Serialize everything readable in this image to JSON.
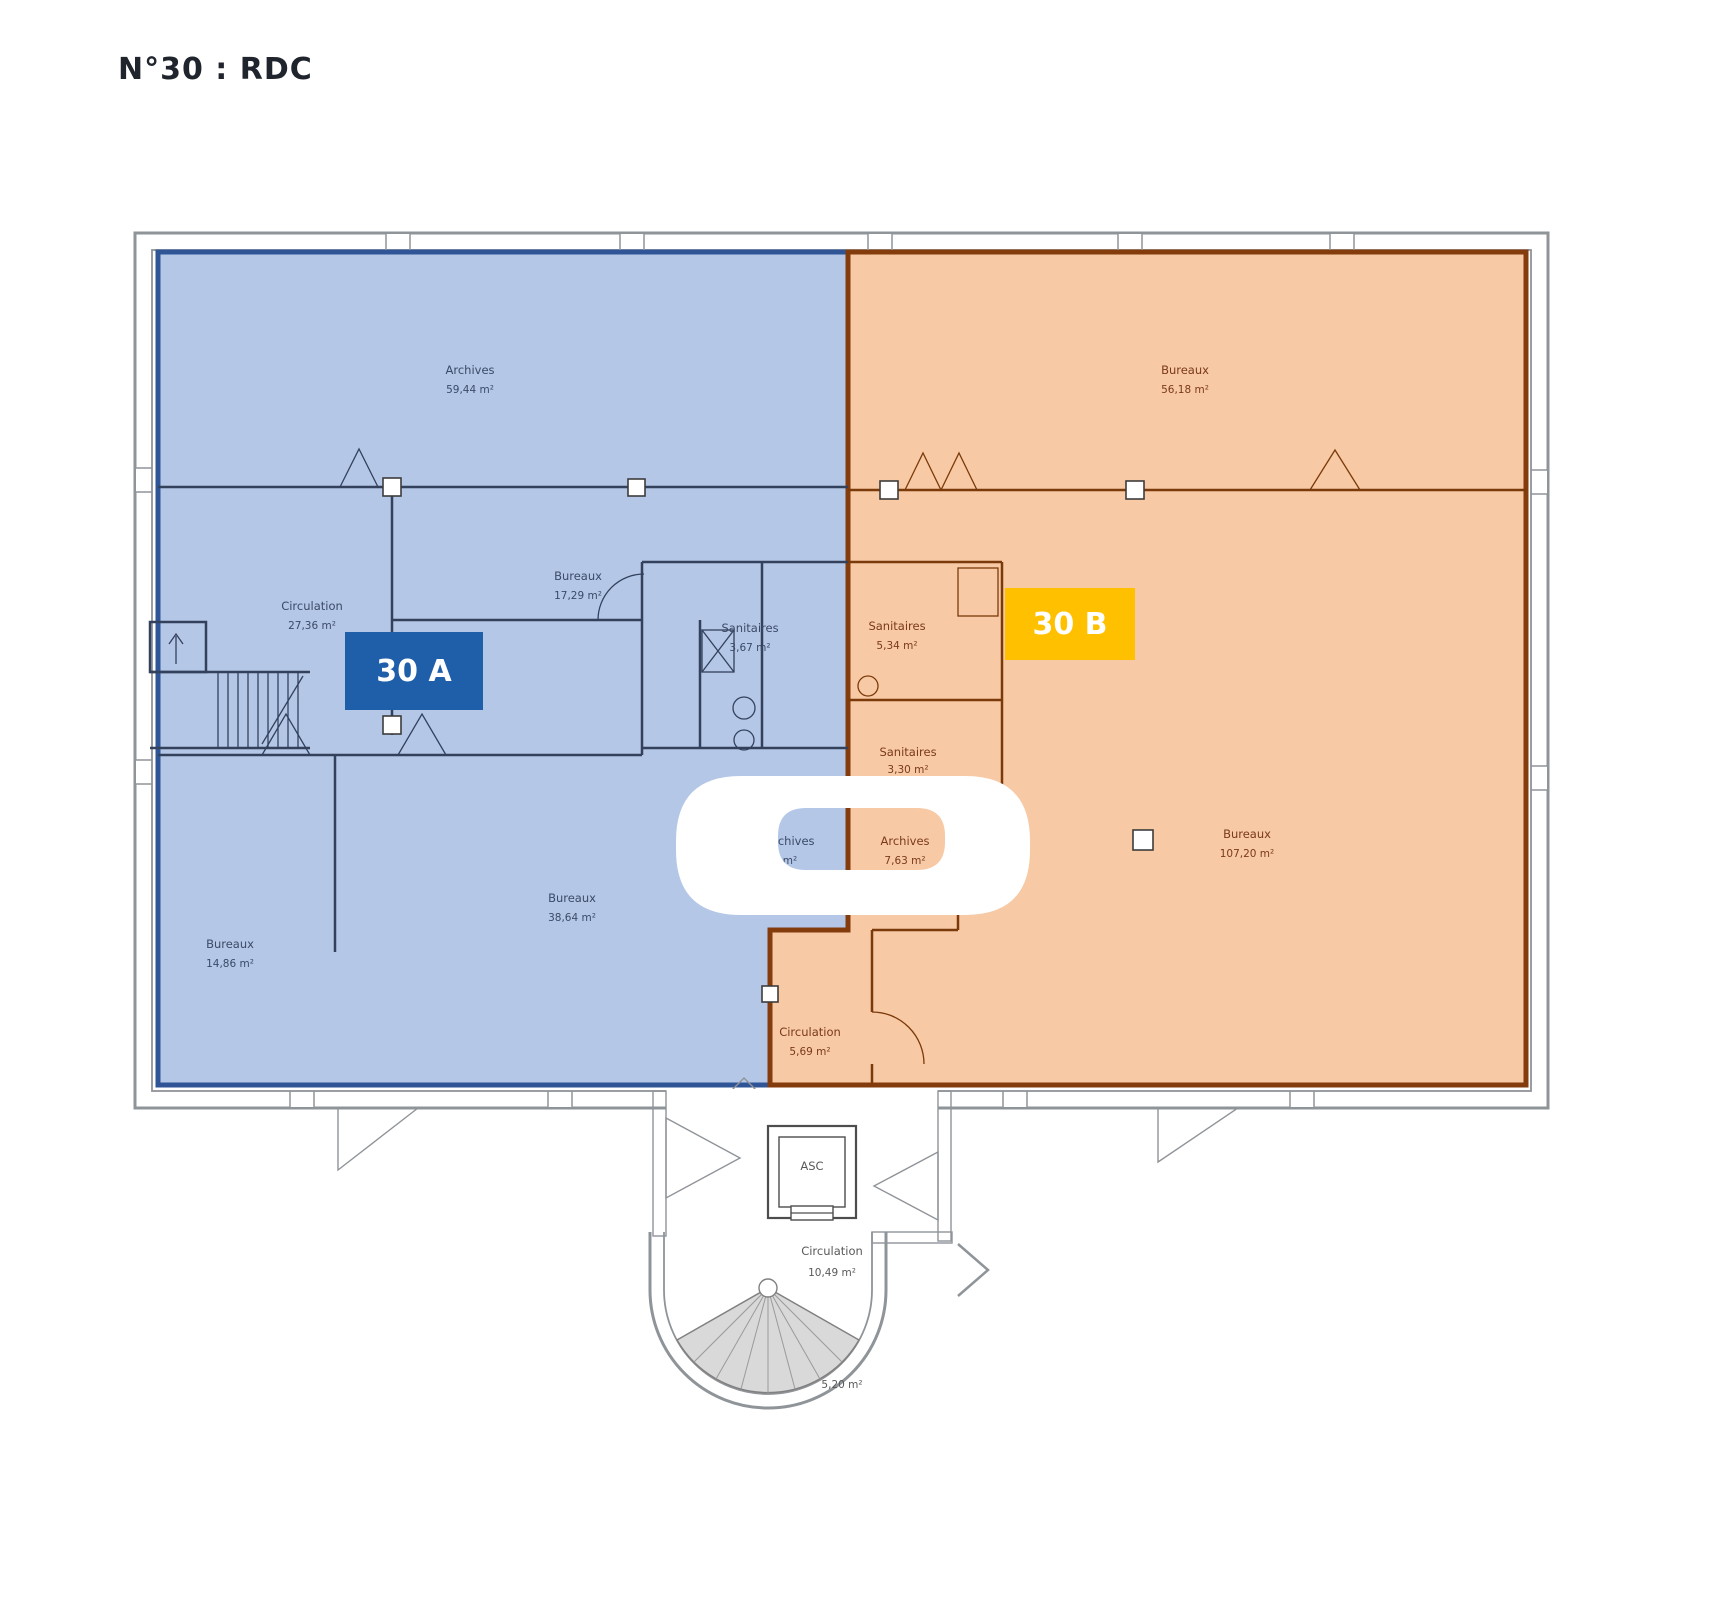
{
  "title": "N°30 : RDC",
  "zones": {
    "a": {
      "label": "30 A",
      "badge_color": "#1f5fa9",
      "fill": "#b4c7e7",
      "border": "#2f5597"
    },
    "b": {
      "label": "30 B",
      "badge_color": "#ffc000",
      "fill": "#f7c9a4",
      "border": "#843c0c"
    }
  },
  "colors": {
    "wall_grey": "#8f9499",
    "interior_wall_blue": "#33415c",
    "interior_wall_orange": "#7b3a0a",
    "label_blue": "#3b4a66",
    "label_orange": "#7b3a1a",
    "label_grey": "#595959",
    "stair_fan": "#d9d9d9"
  },
  "elevator": {
    "label": "ASC"
  },
  "rooms": [
    {
      "name": "Archives",
      "area": "59,44 m²"
    },
    {
      "name": "Bureaux",
      "area": "56,18 m²"
    },
    {
      "name": "Circulation",
      "area": "27,36 m²"
    },
    {
      "name": "Bureaux",
      "area": "17,29 m²"
    },
    {
      "name": "Sanitaires",
      "area": "3,67 m²"
    },
    {
      "name": "Sanitaires",
      "area": "5,34 m²"
    },
    {
      "name": "Sanitaires",
      "area": "3,30 m²"
    },
    {
      "name": "Archives",
      "area": "7,63 m²"
    },
    {
      "name": "Bureaux",
      "area": "107,20 m²"
    },
    {
      "name": "Bureaux",
      "area": "14,86 m²"
    },
    {
      "name": "Bureaux",
      "area": "38,64 m²"
    },
    {
      "name": "Circulation",
      "area": "5,69 m²"
    },
    {
      "name": "Archives",
      "area": "m²"
    },
    {
      "name": "Circulation",
      "area": "10,49 m²"
    },
    {
      "name": "",
      "area": "5,20 m²"
    }
  ]
}
